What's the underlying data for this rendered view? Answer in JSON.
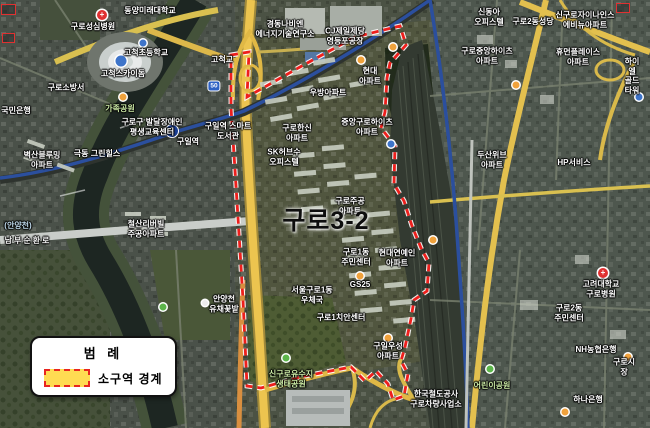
{
  "map": {
    "district_label": "구로3-2",
    "station_badge": {
      "line": "1",
      "x": 172,
      "y": 131
    },
    "road_shield": {
      "text": "50",
      "x": 214,
      "y": 86
    },
    "colors": {
      "boundary_red": "#ee1f1c",
      "boundary_halo": "#ffffff",
      "legend_yellow": "#ffdb52",
      "road_yellow": "#ecc44f",
      "metro_blue": "#2b4f9e",
      "water_dark": "#1d2622"
    },
    "labels": [
      {
        "name": "guro-sungshim-hospital",
        "text": "구로성심병원",
        "x": 93,
        "y": 27,
        "kind": "default"
      },
      {
        "name": "dongyang-mirae-univ",
        "text": "동양미래대학교",
        "x": 150,
        "y": 11,
        "kind": "default"
      },
      {
        "name": "gocheok-elementary",
        "text": "고척초등학교",
        "x": 146,
        "y": 53,
        "kind": "default"
      },
      {
        "name": "gocheok-skydome",
        "text": "고척스카이돔",
        "x": 123,
        "y": 74,
        "kind": "default"
      },
      {
        "name": "guro-fire-station",
        "text": "구로소방서",
        "x": 66,
        "y": 88,
        "kind": "default"
      },
      {
        "name": "family-park",
        "text": "가족공원",
        "x": 120,
        "y": 109,
        "kind": "park"
      },
      {
        "name": "kb-bank",
        "text": "국민은행",
        "x": 16,
        "y": 111,
        "kind": "default"
      },
      {
        "name": "edu-center",
        "text": "구로구 발달장애인\n평생교육센터",
        "x": 152,
        "y": 127,
        "kind": "default"
      },
      {
        "name": "guil-station",
        "text": "구일역",
        "x": 188,
        "y": 142,
        "kind": "default"
      },
      {
        "name": "guil-smart-library",
        "text": "구일역 스마트\n도서관",
        "x": 228,
        "y": 131,
        "kind": "default"
      },
      {
        "name": "byeoksan-blooming-apt",
        "text": "벽산블루밍\n아파트",
        "x": 42,
        "y": 160,
        "kind": "default"
      },
      {
        "name": "geukdong-greenhills",
        "text": "극동 그린힐스",
        "x": 97,
        "y": 154,
        "kind": "default"
      },
      {
        "name": "cheolsan-riverville",
        "text": "철산리버빌\n주공아파트",
        "x": 146,
        "y": 229,
        "kind": "default"
      },
      {
        "name": "nambu-beltway",
        "text": "남부순환로",
        "x": 28,
        "y": 241,
        "kind": "road"
      },
      {
        "name": "anyangcheon",
        "text": "(안양천)",
        "x": 18,
        "y": 226,
        "kind": "water"
      },
      {
        "name": "yuchae-field",
        "text": "안양천\n유채꽃밭",
        "x": 224,
        "y": 304,
        "kind": "default"
      },
      {
        "name": "gocheok-bridge",
        "text": "고척교",
        "x": 222,
        "y": 60,
        "kind": "default"
      },
      {
        "name": "kyungdong-navien-lab",
        "text": "경동나비엔\n에너지기술연구소",
        "x": 285,
        "y": 29,
        "kind": "default"
      },
      {
        "name": "cj-factory",
        "text": "CJ제일제당\n영등포공장",
        "x": 345,
        "y": 36,
        "kind": "default"
      },
      {
        "name": "hyundai-apt",
        "text": "현대\n아파트",
        "x": 370,
        "y": 76,
        "kind": "default"
      },
      {
        "name": "ubang-apt",
        "text": "우방아파트",
        "x": 328,
        "y": 93,
        "kind": "default"
      },
      {
        "name": "jungang-guro-heights",
        "text": "중앙구로하이츠\n아파트",
        "x": 367,
        "y": 127,
        "kind": "default"
      },
      {
        "name": "guro-hanshin-apt",
        "text": "구로한신\n아파트",
        "x": 297,
        "y": 133,
        "kind": "default"
      },
      {
        "name": "sk-hub-officetel",
        "text": "SK허브수\n오피스텔",
        "x": 284,
        "y": 157,
        "kind": "default"
      },
      {
        "name": "guro-jugong-apt",
        "text": "구로주공\n아파트",
        "x": 350,
        "y": 206,
        "kind": "default"
      },
      {
        "name": "guro1-community-center",
        "text": "구로1동\n주민센터",
        "x": 356,
        "y": 257,
        "kind": "default"
      },
      {
        "name": "hyundai-yeonyein-apt",
        "text": "현대연예인\n아파트",
        "x": 397,
        "y": 258,
        "kind": "default"
      },
      {
        "name": "gs25",
        "text": "GS25",
        "x": 360,
        "y": 285,
        "kind": "default"
      },
      {
        "name": "guro1-post-office",
        "text": "서울구로1동\n우체국",
        "x": 312,
        "y": 295,
        "kind": "default"
      },
      {
        "name": "guro1-police-box",
        "text": "구로1치안센터",
        "x": 341,
        "y": 318,
        "kind": "default"
      },
      {
        "name": "guil-woosung-apt",
        "text": "구일우성\n아파트",
        "x": 388,
        "y": 351,
        "kind": "default"
      },
      {
        "name": "singuro-eco-park",
        "text": "신구로유수지\n생태공원",
        "x": 291,
        "y": 379,
        "kind": "park"
      },
      {
        "name": "korail-guro-depot",
        "text": "한국철도공사\n구로차량사업소",
        "x": 436,
        "y": 399,
        "kind": "default"
      },
      {
        "name": "shindonga-officetel",
        "text": "신동아\n오피스텔",
        "x": 489,
        "y": 17,
        "kind": "default"
      },
      {
        "name": "guro2-cathedral",
        "text": "구로2동성당",
        "x": 533,
        "y": 22,
        "kind": "default"
      },
      {
        "name": "singuro-xi-apt",
        "text": "신구로자이나인스\n에비뉴아파트",
        "x": 585,
        "y": 20,
        "kind": "default"
      },
      {
        "name": "guro-jungang-heights",
        "text": "구로중앙하이츠\n아파트",
        "x": 487,
        "y": 56,
        "kind": "default"
      },
      {
        "name": "human-place-apt",
        "text": "휴먼플레이스\n아파트",
        "x": 578,
        "y": 57,
        "kind": "default"
      },
      {
        "name": "hiel-goldtower",
        "text": "하이엘\n골드타워",
        "x": 632,
        "y": 76,
        "kind": "default"
      },
      {
        "name": "doosan-weve-apt",
        "text": "두산위브\n아파트",
        "x": 492,
        "y": 160,
        "kind": "default"
      },
      {
        "name": "hp-service",
        "text": "HP서비스",
        "x": 574,
        "y": 163,
        "kind": "default"
      },
      {
        "name": "korea-univ-guro-hospital",
        "text": "고려대학교\n구로병원",
        "x": 601,
        "y": 289,
        "kind": "default"
      },
      {
        "name": "guro2-community-center",
        "text": "구로2동\n주민센터",
        "x": 569,
        "y": 313,
        "kind": "default"
      },
      {
        "name": "nh-bank",
        "text": "NH농협은행",
        "x": 596,
        "y": 350,
        "kind": "default"
      },
      {
        "name": "guro-market",
        "text": "구로시장",
        "x": 624,
        "y": 367,
        "kind": "default"
      },
      {
        "name": "children-park",
        "text": "어린이공원",
        "x": 492,
        "y": 386,
        "kind": "park"
      },
      {
        "name": "hana-bank",
        "text": "하나은행",
        "x": 588,
        "y": 400,
        "kind": "default"
      }
    ],
    "markers": [
      {
        "kind": "red-cross",
        "x": 102,
        "y": 15
      },
      {
        "kind": "red-cross",
        "x": 603,
        "y": 273
      },
      {
        "kind": "blue-lg",
        "x": 121,
        "y": 61
      },
      {
        "kind": "blue",
        "x": 143,
        "y": 43
      },
      {
        "kind": "blue",
        "x": 391,
        "y": 144
      },
      {
        "kind": "blue",
        "x": 639,
        "y": 97
      },
      {
        "kind": "orange",
        "x": 361,
        "y": 60
      },
      {
        "kind": "orange",
        "x": 393,
        "y": 47
      },
      {
        "kind": "orange",
        "x": 433,
        "y": 240
      },
      {
        "kind": "orange",
        "x": 360,
        "y": 276
      },
      {
        "kind": "orange",
        "x": 388,
        "y": 338
      },
      {
        "kind": "orange",
        "x": 516,
        "y": 85
      },
      {
        "kind": "orange",
        "x": 628,
        "y": 357
      },
      {
        "kind": "orange",
        "x": 565,
        "y": 412
      },
      {
        "kind": "orange",
        "x": 123,
        "y": 97
      },
      {
        "kind": "green",
        "x": 163,
        "y": 307
      },
      {
        "kind": "green",
        "x": 286,
        "y": 358
      },
      {
        "kind": "green",
        "x": 490,
        "y": 369
      },
      {
        "kind": "white",
        "x": 205,
        "y": 303
      }
    ]
  },
  "legend": {
    "title": "범 례",
    "items": [
      {
        "label": "소구역 경계",
        "swatch_fill": "#ffdb52",
        "swatch_border": "#e8251f"
      }
    ]
  }
}
